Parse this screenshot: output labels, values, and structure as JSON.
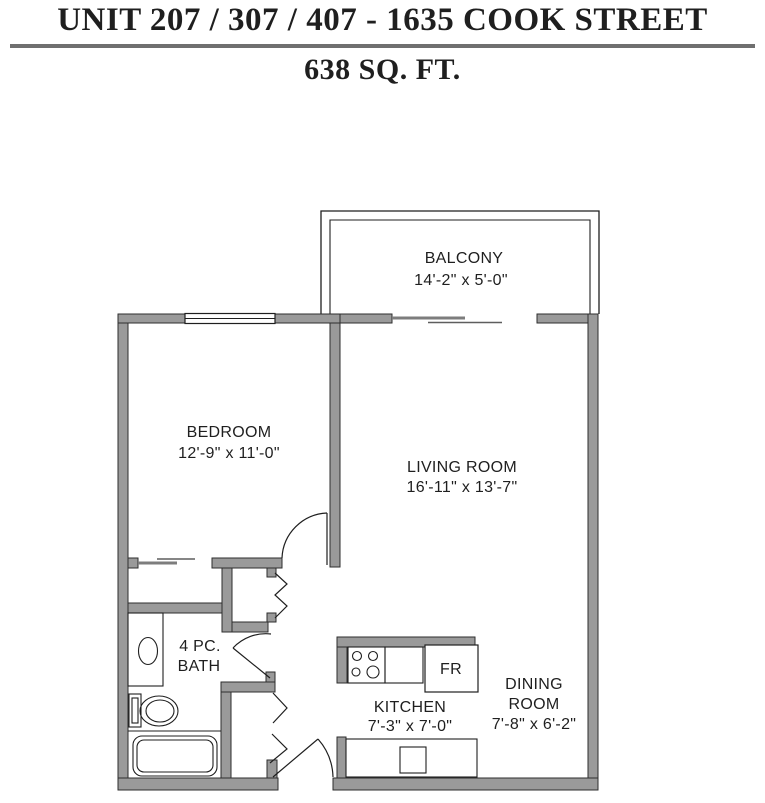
{
  "header": {
    "title": "UNIT 207 / 307 / 407 - 1635 COOK STREET",
    "subtitle": "638 SQ. FT."
  },
  "rooms": {
    "balcony": {
      "name": "BALCONY",
      "dims": "14'-2\" x 5'-0\""
    },
    "bedroom": {
      "name": "BEDROOM",
      "dims": "12'-9\" x 11'-0\""
    },
    "living_room": {
      "name": "LIVING ROOM",
      "dims": "16'-11\" x 13'-7\""
    },
    "bathroom": {
      "line1": "4 PC.",
      "line2": "BATH"
    },
    "kitchen": {
      "name": "KITCHEN",
      "dims": "7'-3\" x 7'-0\""
    },
    "dining_room": {
      "line1": "DINING",
      "line2": "ROOM",
      "dims": "7'-8\" x 6'-2\""
    }
  },
  "appliances": {
    "fridge_label": "FR"
  },
  "colors": {
    "wall_fill": "#9a9a9a",
    "wall_outline": "#2e2e2e",
    "line": "#1f1f1f",
    "text": "#1f1f1f",
    "underline": "#6f6f6f",
    "background": "#ffffff"
  }
}
